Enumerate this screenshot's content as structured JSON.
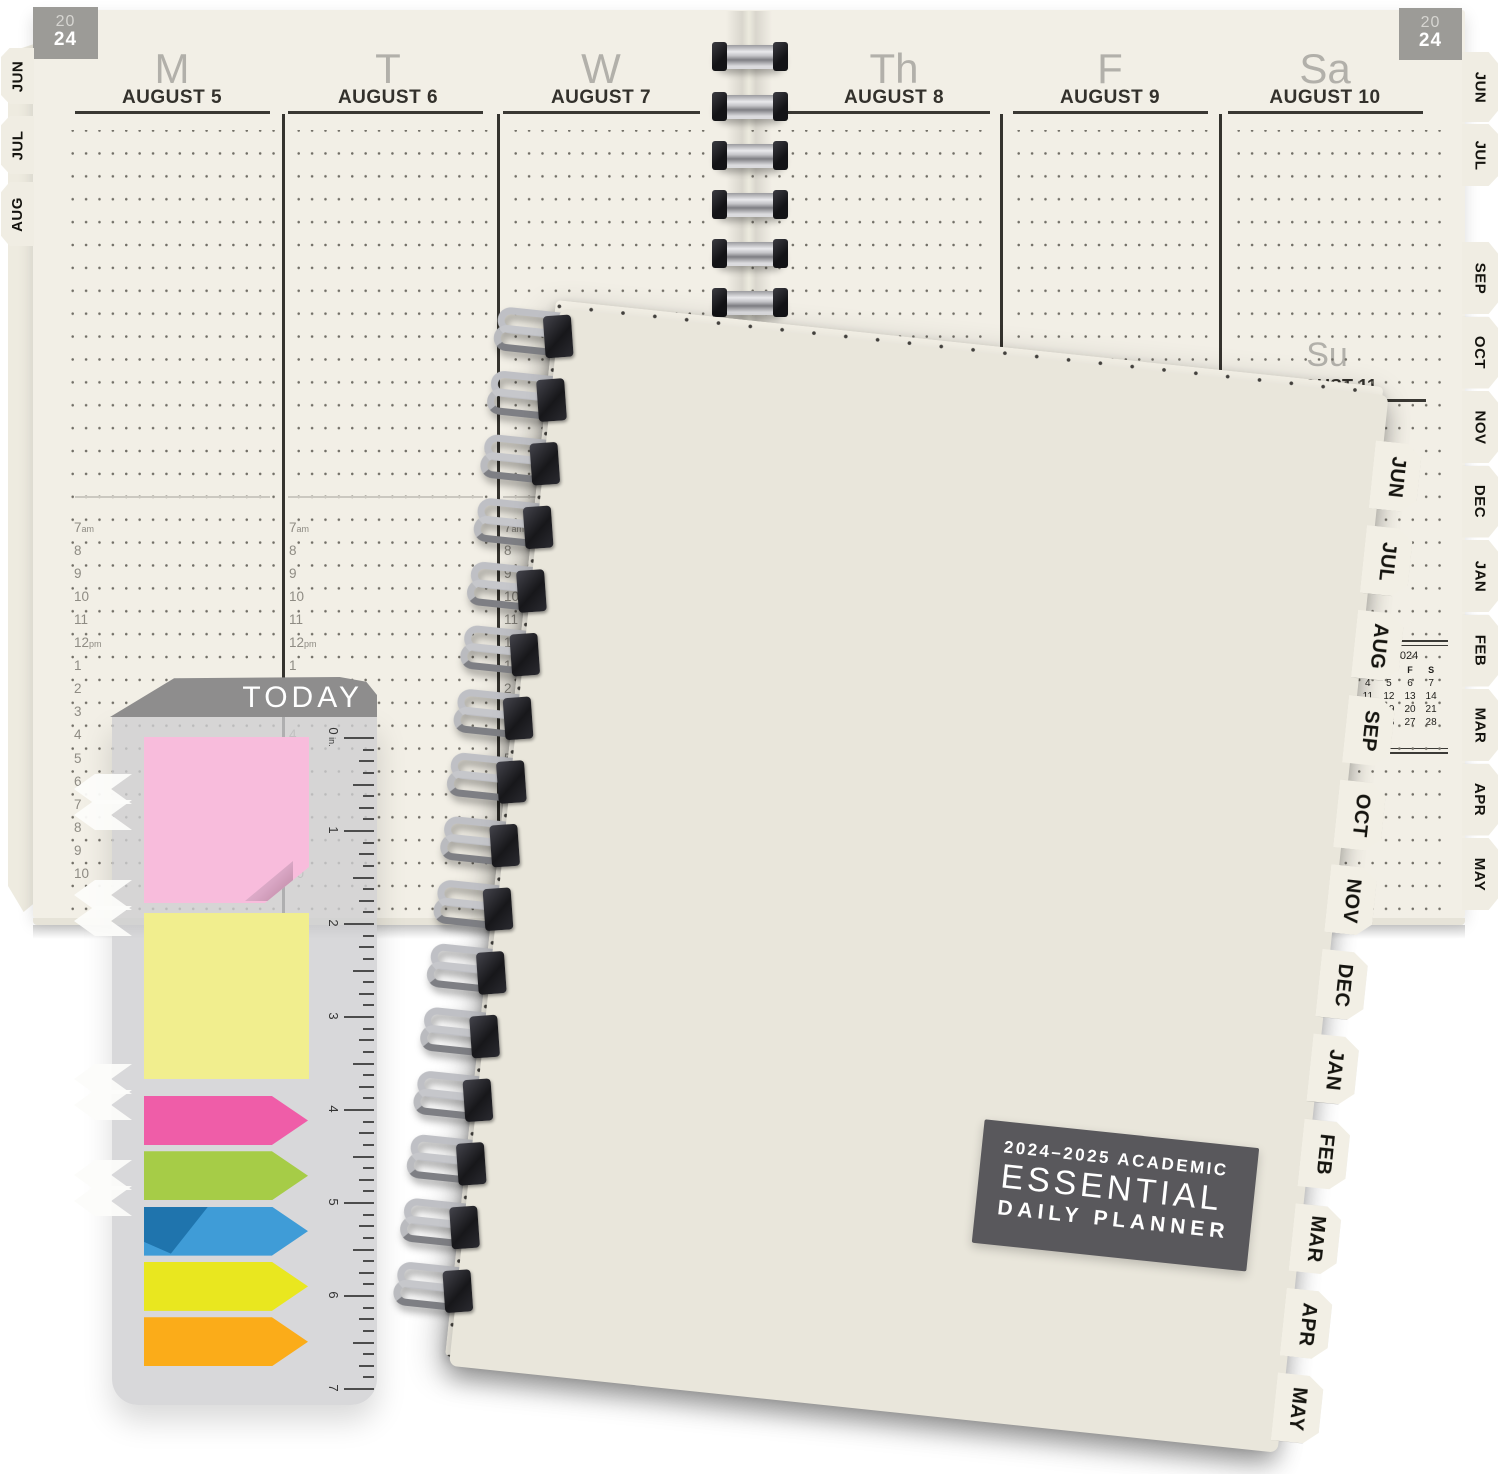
{
  "spread": {
    "year": {
      "top": "20",
      "bottom": "24"
    },
    "days": [
      {
        "letter": "M",
        "date": "AUGUST 5"
      },
      {
        "letter": "T",
        "date": "AUGUST 6"
      },
      {
        "letter": "W",
        "date": "AUGUST 7"
      },
      {
        "letter": "Th",
        "date": "AUGUST 8"
      },
      {
        "letter": "F",
        "date": "AUGUST 9"
      },
      {
        "letter": "Sa",
        "date": "AUGUST 10"
      }
    ],
    "sunday": {
      "letter": "Su",
      "date": "AUGUST 11"
    },
    "times": [
      "7am",
      "8",
      "9",
      "10",
      "11",
      "12pm",
      "1",
      "2",
      "3",
      "4",
      "5",
      "6",
      "7",
      "8",
      "9",
      "10"
    ],
    "left_tabs": [
      "JUN",
      "JUL",
      "AUG"
    ],
    "right_tabs_top": [
      "JUN",
      "JUL"
    ],
    "right_tabs": [
      "SEP",
      "OCT",
      "NOV",
      "DEC",
      "JAN",
      "FEB",
      "MAR",
      "APR",
      "MAY"
    ],
    "mini_calendar": {
      "month": "SEPTEMBER",
      "year": "2024",
      "day_header": [
        "S",
        "M",
        "T",
        "W",
        "T",
        "F",
        "S"
      ],
      "weeks": [
        [
          "1",
          "2",
          "3",
          "4",
          "5",
          "6",
          "7"
        ],
        [
          "8",
          "9",
          "10",
          "11",
          "12",
          "13",
          "14"
        ],
        [
          "15",
          "16",
          "17",
          "18",
          "19",
          "20",
          "21"
        ],
        [
          "22",
          "23",
          "24",
          "25",
          "26",
          "27",
          "28"
        ],
        [
          "29",
          "30",
          "",
          "",
          "",
          "",
          ""
        ]
      ]
    }
  },
  "pack": {
    "banner": "TODAY",
    "ruler_numbers": [
      "0 in.",
      "1",
      "2",
      "3",
      "4",
      "5",
      "6",
      "7"
    ]
  },
  "notebook": {
    "tabs": [
      "JUN",
      "JUL",
      "AUG",
      "SEP",
      "OCT",
      "NOV",
      "DEC",
      "JAN",
      "FEB",
      "MAR",
      "APR",
      "MAY"
    ],
    "label": {
      "line1": "2024–2025 ACADEMIC",
      "line2": "ESSENTIAL",
      "line3": "DAILY PLANNER"
    }
  },
  "colors": {
    "page_cream": "#f2efe6",
    "cover_cream": "#f3f0e6",
    "year_tab_gray": "#9c9b97",
    "banner_gray": "#8e8d8d",
    "label_box_gray": "#59585c",
    "sticky_pink": "#f8bcdc",
    "sticky_yellow": "#f1ee8e",
    "flag_colors": [
      "#ef5da8",
      "#a6cc47",
      "#3f9cd7",
      "#e9e71f",
      "#fbac19"
    ]
  }
}
